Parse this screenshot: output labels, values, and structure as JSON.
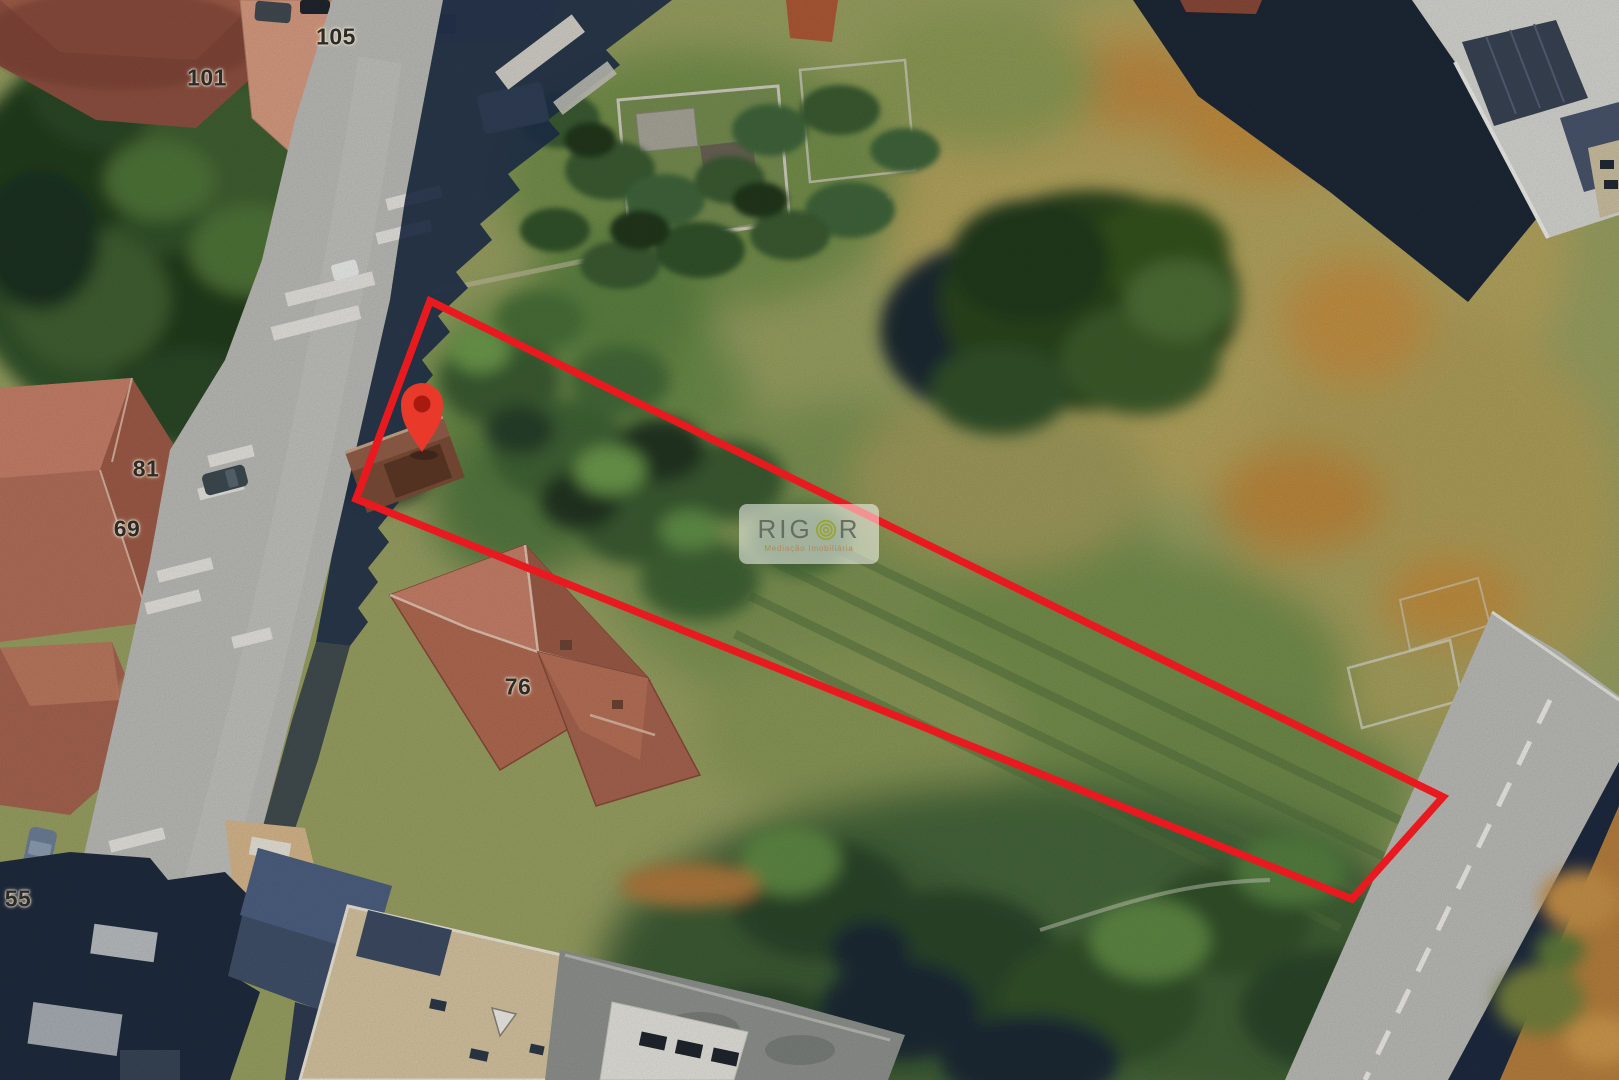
{
  "watermark": {
    "brand_prefix": "RIG",
    "brand_suffix": "R",
    "logo": "concentric-rings-o-logo",
    "tagline": "Mediação Imobiliária"
  },
  "house_numbers": [
    {
      "value": "105"
    },
    {
      "value": "101"
    },
    {
      "value": "81"
    },
    {
      "value": "69"
    },
    {
      "value": "76"
    },
    {
      "value": "55"
    }
  ],
  "annotations": {
    "plot_outline": {
      "points": "430,301 1443,797 1352,899 356,499",
      "color": "#e81a1f",
      "stroke_width": "7.5"
    },
    "pin": {
      "transform": "translate(422,405)",
      "body_color": "#e8392b",
      "inner_color": "#a81a10"
    }
  },
  "palette": {
    "outline_red": "#e81a1f",
    "pin_red": "#e8392b",
    "watermark_logo_green": "#99a33c",
    "field_olive": "#9aa263",
    "road_gray": "#bdbdb9",
    "shadow_navy": "#202c3e",
    "roof_terracotta": "#b26b53"
  }
}
